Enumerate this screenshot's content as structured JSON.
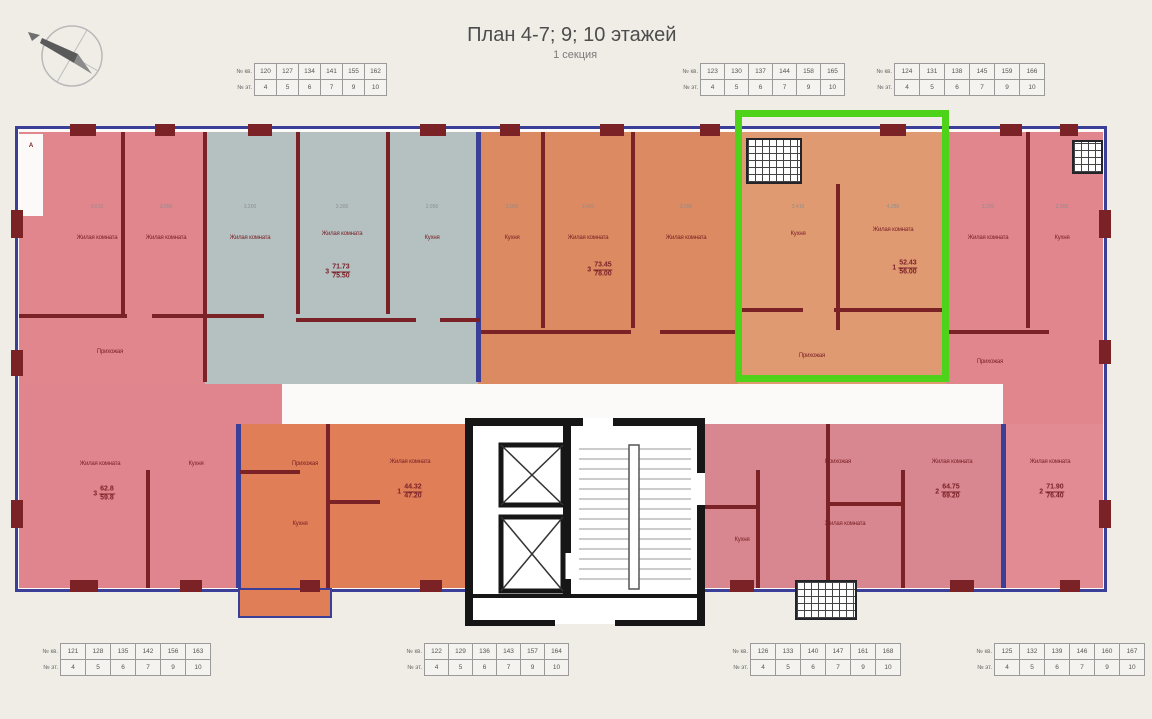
{
  "header": {
    "title": "План 4-7; 9; 10 этажей",
    "subtitle": "1 секция"
  },
  "palette": {
    "background": "#f0ede7",
    "plan_base": "#fbfaf8",
    "pink_top_left": "#e2868e",
    "gray_blue": "#b5c1c1",
    "orange_center": "#dc8a62",
    "orange_selected": "#e09a72",
    "pink_top_right": "#e2868e",
    "pink_bottom_left": "#e0858d",
    "orange_bottom": "#e07e58",
    "rose_bottom_right": "#d8868f",
    "rose_corner": "#e28b93",
    "wall_maroon": "#7b2227",
    "wall_blue": "#3b3f97",
    "core_black": "#1b1b1b",
    "highlight": "#4fd31a"
  },
  "table_labels": [
    "№ кв.",
    "№ эт."
  ],
  "floors": [
    "4",
    "5",
    "6",
    "7",
    "9",
    "10"
  ],
  "tables": [
    {
      "x": 222,
      "y": 64,
      "cw": 21,
      "apts": [
        "120",
        "127",
        "134",
        "141",
        "155",
        "162"
      ]
    },
    {
      "x": 668,
      "y": 64,
      "cw": 23,
      "apts": [
        "123",
        "130",
        "137",
        "144",
        "158",
        "165"
      ]
    },
    {
      "x": 862,
      "y": 64,
      "cw": 24,
      "apts": [
        "124",
        "131",
        "138",
        "145",
        "159",
        "166"
      ]
    },
    {
      "x": 28,
      "y": 644,
      "cw": 24,
      "apts": [
        "121",
        "128",
        "135",
        "142",
        "156",
        "163"
      ]
    },
    {
      "x": 392,
      "y": 644,
      "cw": 23,
      "apts": [
        "122",
        "129",
        "136",
        "143",
        "157",
        "164"
      ]
    },
    {
      "x": 718,
      "y": 644,
      "cw": 24,
      "apts": [
        "126",
        "133",
        "140",
        "147",
        "161",
        "168"
      ]
    },
    {
      "x": 962,
      "y": 644,
      "cw": 24,
      "apts": [
        "125",
        "132",
        "139",
        "146",
        "160",
        "167"
      ]
    }
  ],
  "selected_apartment": {
    "living_area": "52.43",
    "total_area": "56.00",
    "rooms": "1"
  },
  "plan": {
    "section_marker": "А",
    "room_labels": [
      {
        "t": "Жилая комната",
        "x": 97,
        "y": 238
      },
      {
        "t": "Жилая комната",
        "x": 166,
        "y": 238
      },
      {
        "t": "Прихожая",
        "x": 110,
        "y": 352
      },
      {
        "t": "Жилая комната",
        "x": 250,
        "y": 238
      },
      {
        "t": "Жилая комната",
        "x": 342,
        "y": 234
      },
      {
        "t": "Кухня",
        "x": 432,
        "y": 238
      },
      {
        "t": "Кухня",
        "x": 512,
        "y": 238
      },
      {
        "t": "Жилая комната",
        "x": 588,
        "y": 238
      },
      {
        "t": "Жилая комната",
        "x": 686,
        "y": 238
      },
      {
        "t": "Кухня",
        "x": 798,
        "y": 234
      },
      {
        "t": "Жилая комната",
        "x": 893,
        "y": 230
      },
      {
        "t": "Прихожая",
        "x": 812,
        "y": 356
      },
      {
        "t": "Жилая комната",
        "x": 988,
        "y": 238
      },
      {
        "t": "Кухня",
        "x": 1062,
        "y": 238
      },
      {
        "t": "Прихожая",
        "x": 990,
        "y": 362
      },
      {
        "t": "Жилая комната",
        "x": 100,
        "y": 464
      },
      {
        "t": "Кухня",
        "x": 196,
        "y": 464
      },
      {
        "t": "Прихожая",
        "x": 305,
        "y": 464
      },
      {
        "t": "Кухня",
        "x": 300,
        "y": 524
      },
      {
        "t": "Жилая комната",
        "x": 410,
        "y": 462
      },
      {
        "t": "Кухня",
        "x": 742,
        "y": 540
      },
      {
        "t": "Прихожая",
        "x": 838,
        "y": 462
      },
      {
        "t": "Жилая комната",
        "x": 952,
        "y": 462
      },
      {
        "t": "Жилая комната",
        "x": 845,
        "y": 524
      },
      {
        "t": "Жилая комната",
        "x": 1050,
        "y": 462
      }
    ],
    "area_labels": [
      {
        "p": "3",
        "top": "71.73",
        "bot": "75.50",
        "x": 338,
        "y": 272
      },
      {
        "p": "3",
        "top": "73.45",
        "bot": "78.00",
        "x": 600,
        "y": 270
      },
      {
        "p": "1",
        "top": "52.43",
        "bot": "56.00",
        "x": 905,
        "y": 268
      },
      {
        "p": "3",
        "top": "62.8",
        "bot": "59.8",
        "x": 104,
        "y": 494
      },
      {
        "p": "1",
        "top": "44.32",
        "bot": "47.20",
        "x": 410,
        "y": 492
      },
      {
        "p": "2",
        "top": "64.75",
        "bot": "69.20",
        "x": 948,
        "y": 492
      },
      {
        "p": "2",
        "top": "71.90",
        "bot": "76.40",
        "x": 1052,
        "y": 492
      }
    ],
    "dim_labels": [
      {
        "t": "3.610",
        "x": 97,
        "y": 207
      },
      {
        "t": "3.050",
        "x": 166,
        "y": 207
      },
      {
        "t": "3.200",
        "x": 250,
        "y": 207
      },
      {
        "t": "3.300",
        "x": 342,
        "y": 207
      },
      {
        "t": "2.950",
        "x": 432,
        "y": 207
      },
      {
        "t": "3.000",
        "x": 512,
        "y": 207
      },
      {
        "t": "3.400",
        "x": 588,
        "y": 207
      },
      {
        "t": "3.050",
        "x": 686,
        "y": 207
      },
      {
        "t": "3.410",
        "x": 798,
        "y": 207
      },
      {
        "t": "4.280",
        "x": 893,
        "y": 207
      },
      {
        "t": "3.200",
        "x": 988,
        "y": 207
      },
      {
        "t": "2.300",
        "x": 1062,
        "y": 207
      }
    ]
  }
}
